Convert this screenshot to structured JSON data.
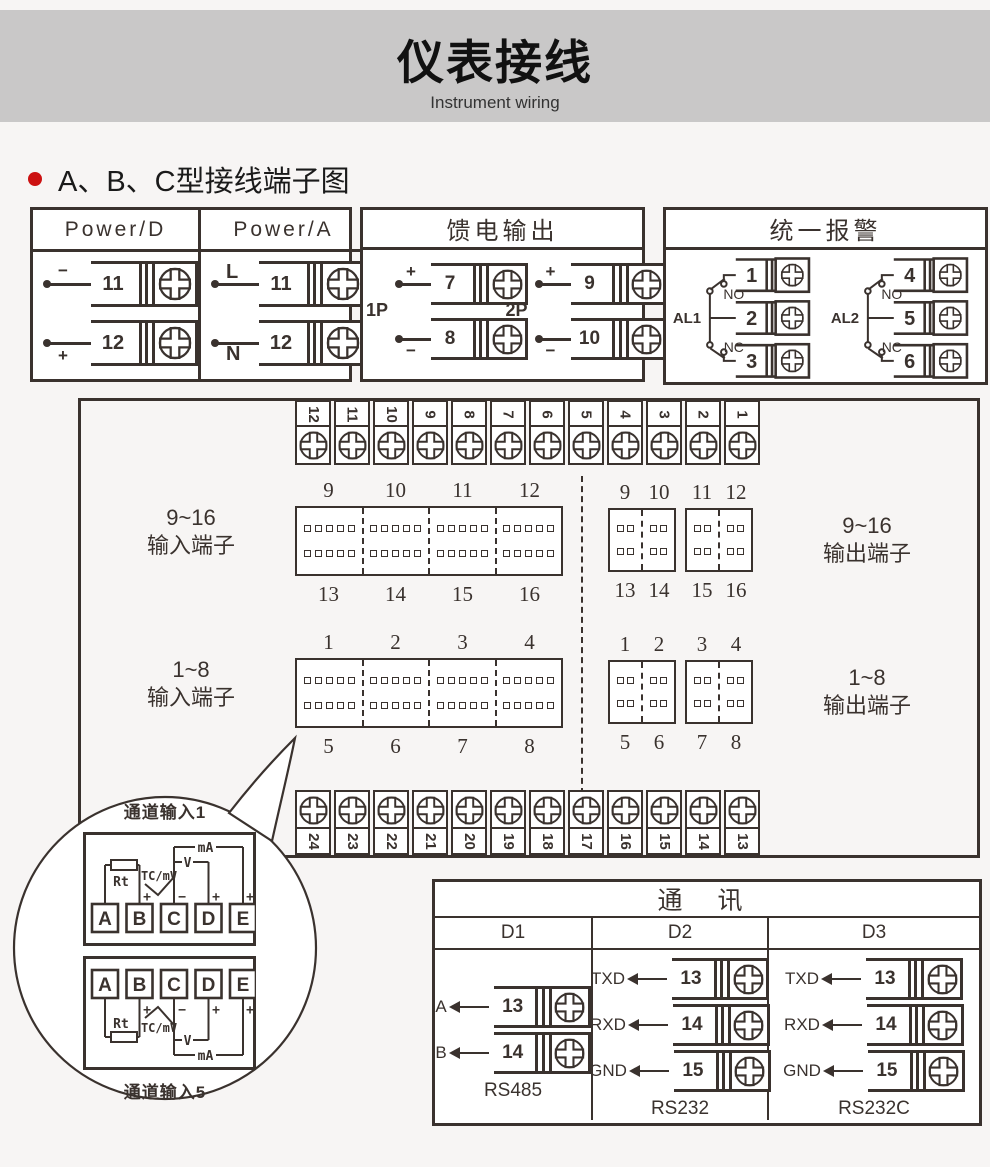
{
  "header": {
    "title": "仪表接线",
    "subtitle": "Instrument wiring"
  },
  "section": {
    "title": "A、B、C型接线端子图"
  },
  "power_box": {
    "columns": [
      {
        "header": "Power/D",
        "terminals": [
          {
            "sign": "−",
            "num": "11"
          },
          {
            "sign": "+",
            "num": "12"
          }
        ]
      },
      {
        "header": "Power/A",
        "terminals": [
          {
            "sign": "L",
            "num": "11"
          },
          {
            "sign": "N",
            "num": "12"
          }
        ]
      }
    ]
  },
  "feed_box": {
    "title": "馈电输出",
    "groups": [
      {
        "label": "1P",
        "terminals": [
          {
            "sign": "+",
            "num": "7"
          },
          {
            "sign": "−",
            "num": "8"
          }
        ]
      },
      {
        "label": "2P",
        "terminals": [
          {
            "sign": "+",
            "num": "9"
          },
          {
            "sign": "−",
            "num": "10"
          }
        ]
      }
    ]
  },
  "alarm_box": {
    "title": "统一报警",
    "groups": [
      {
        "label": "AL1",
        "no": "NO",
        "nc": "NC",
        "terminals": [
          "1",
          "2",
          "3"
        ]
      },
      {
        "label": "AL2",
        "no": "NO",
        "nc": "NC",
        "terminals": [
          "4",
          "5",
          "6"
        ]
      }
    ]
  },
  "main_panel": {
    "top_strip": [
      "12",
      "11",
      "10",
      "9",
      "8",
      "7",
      "6",
      "5",
      "4",
      "3",
      "2",
      "1"
    ],
    "bottom_strip": [
      "24",
      "23",
      "22",
      "21",
      "20",
      "19",
      "18",
      "17",
      "16",
      "15",
      "14",
      "13"
    ],
    "input9_16": {
      "label_line1": "9~16",
      "label_line2": "输入端子",
      "top_nums": [
        "9",
        "10",
        "11",
        "12"
      ],
      "bottom_nums": [
        "13",
        "14",
        "15",
        "16"
      ]
    },
    "output9_16": {
      "label_line1": "9~16",
      "label_line2": "输出端子",
      "top_nums_a": [
        "9",
        "10"
      ],
      "top_nums_b": [
        "11",
        "12"
      ],
      "bottom_nums_a": [
        "13",
        "14"
      ],
      "bottom_nums_b": [
        "15",
        "16"
      ]
    },
    "input1_8": {
      "label_line1": "1~8",
      "label_line2": "输入端子",
      "top_nums": [
        "1",
        "2",
        "3",
        "4"
      ],
      "bottom_nums": [
        "5",
        "6",
        "7",
        "8"
      ]
    },
    "output1_8": {
      "label_line1": "1~8",
      "label_line2": "输出端子",
      "top_nums_a": [
        "1",
        "2"
      ],
      "top_nums_b": [
        "3",
        "4"
      ],
      "bottom_nums_a": [
        "5",
        "6"
      ],
      "bottom_nums_b": [
        "7",
        "8"
      ]
    }
  },
  "callout": {
    "top_label": "通道输入1",
    "bottom_label": "通道输入5",
    "channel_terminals": [
      "A",
      "B",
      "C",
      "D",
      "E"
    ],
    "rt_label": "Rt",
    "tc_label": "TC/mV",
    "v_label": "V",
    "ma_label": "mA",
    "plus": "+",
    "minus": "−"
  },
  "comm_box": {
    "title": "通  讯",
    "columns": [
      {
        "header": "D1",
        "caption": "RS485",
        "rows": [
          {
            "label": "A",
            "num": "13"
          },
          {
            "label": "B",
            "num": "14"
          }
        ]
      },
      {
        "header": "D2",
        "caption": "RS232",
        "rows": [
          {
            "label": "TXD",
            "num": "13"
          },
          {
            "label": "RXD",
            "num": "14"
          },
          {
            "label": "GND",
            "num": "15"
          }
        ]
      },
      {
        "header": "D3",
        "caption": "RS232C",
        "rows": [
          {
            "label": "TXD",
            "num": "13"
          },
          {
            "label": "RXD",
            "num": "14"
          },
          {
            "label": "GND",
            "num": "15"
          }
        ]
      }
    ]
  }
}
